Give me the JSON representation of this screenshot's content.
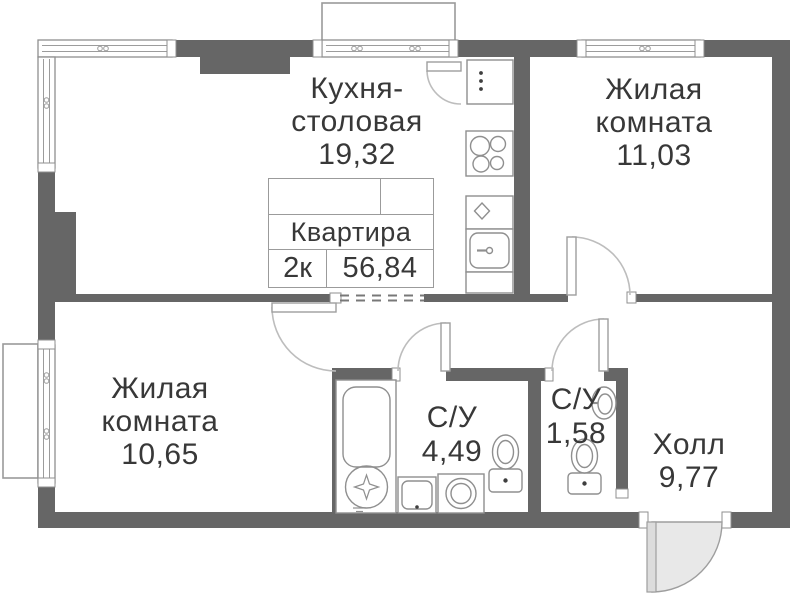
{
  "plan": {
    "title_block": {
      "title": "Квартира",
      "rooms_count": "2к",
      "total_area": "56,84"
    },
    "rooms": [
      {
        "id": "kitchen-dining",
        "name_line1": "Кухня-",
        "name_line2": "столовая",
        "area": "19,32"
      },
      {
        "id": "living-room-1",
        "name_line1": "Жилая",
        "name_line2": "комната",
        "area": "11,03"
      },
      {
        "id": "living-room-2",
        "name_line1": "Жилая",
        "name_line2": "комната",
        "area": "10,65"
      },
      {
        "id": "bathroom-big",
        "name_line1": "С/У",
        "area": "4,49"
      },
      {
        "id": "bathroom-small",
        "name_line1": "С/У",
        "area": "1,58"
      },
      {
        "id": "hall",
        "name_line1": "Холл",
        "area": "9,77"
      }
    ],
    "colors": {
      "wall": "#666666",
      "fixture_line": "#8f8f8f",
      "door_arc": "#bdbdbd",
      "entrance_door_fill": "#e8e8e8",
      "text": "#383838"
    }
  }
}
